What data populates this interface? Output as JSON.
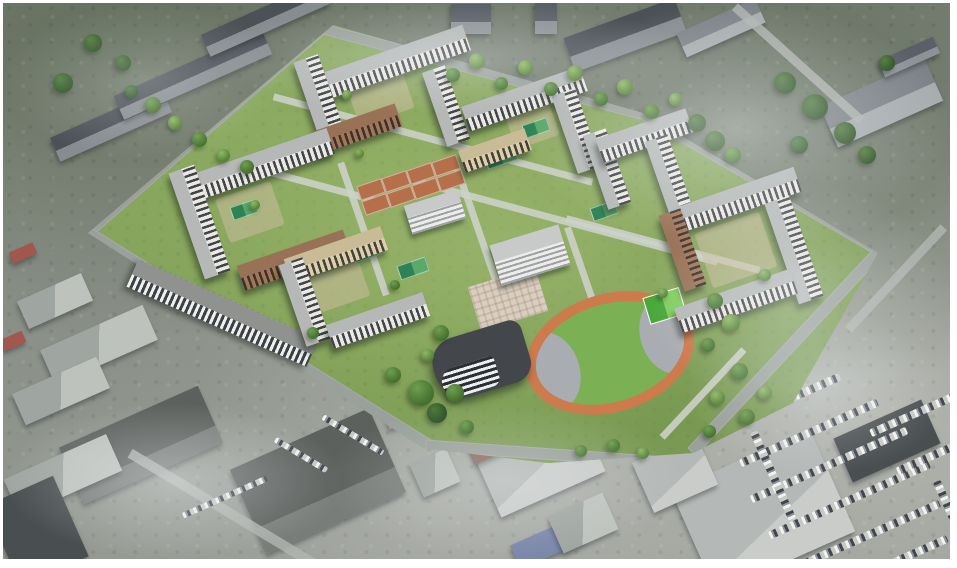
{
  "scene": {
    "description": "Aerial bird's-eye architectural rendering of a new residential masterplan with mid-rise perimeter apartment blocks, a school, a kindergarten, clay sport courts, a stadium with orange running track and a rounded striped parking garage, superimposed on a hazy desaturated aerial photo of surrounding industrial sheds, gray slab buildings, streets and a large car parking lot",
    "palette": {
      "frame": "#ffffff",
      "photo_base": "#8e938c",
      "lawn": "#83a159",
      "road": "#9aa09b",
      "path": "#cdd2cb",
      "facade_light": "#e9e7e1",
      "facade_brown": "#9f6b44",
      "facade_tan": "#dcca9f",
      "window_dark": "#2a2f35",
      "roof_gray": "#b5b8b7",
      "clay_court": "#b5704b",
      "sport_court_dark": "#2e8355",
      "sport_court_light": "#5aa96a",
      "track_orange": "#cd7a4c",
      "infield_green": "#7cb054",
      "end_zone_gray": "#a9adb2",
      "tree_dark": "#2f5226",
      "tree_mid": "#44702f",
      "tree_bright": "#8cba62",
      "haze": "#ebeef0"
    },
    "format_note": "geometry arrays are [cx,cy,w,h,rot,(tone)] in px; trees are [cx,cy,diameter,tone]; haze is [left%,top%,w%,h%,opacity]"
  },
  "surroundings": {
    "buildings": [
      [
        108,
        122,
        122,
        26,
        -24,
        "slab"
      ],
      [
        190,
        72,
        162,
        26,
        -24,
        "slab"
      ],
      [
        263,
        16,
        132,
        24,
        -24,
        "slab"
      ],
      [
        468,
        16,
        40,
        30,
        0,
        "box"
      ],
      [
        543,
        15,
        22,
        32,
        0,
        "box"
      ],
      [
        622,
        32,
        118,
        36,
        -20,
        "slab"
      ],
      [
        718,
        25,
        86,
        26,
        -24,
        "boxlight"
      ],
      [
        878,
        100,
        115,
        45,
        -24,
        "boxlight"
      ],
      [
        906,
        54,
        60,
        18,
        -24,
        "box"
      ],
      [
        52,
        298,
        70,
        30,
        -24,
        "shed"
      ],
      [
        96,
        342,
        112,
        38,
        -24,
        "shed"
      ],
      [
        58,
        388,
        92,
        34,
        -24,
        "shed"
      ],
      [
        138,
        442,
        152,
        62,
        -24,
        "dark"
      ],
      [
        60,
        472,
        112,
        40,
        -24,
        "shed"
      ],
      [
        34,
        528,
        74,
        88,
        -24,
        "darker"
      ],
      [
        20,
        250,
        26,
        12,
        -24,
        "red"
      ],
      [
        10,
        338,
        24,
        12,
        -24,
        "red"
      ],
      [
        315,
        478,
        152,
        92,
        -24,
        "dark"
      ],
      [
        533,
        452,
        114,
        86,
        -24,
        "lightroof"
      ],
      [
        760,
        508,
        152,
        112,
        -24,
        "lightroof"
      ],
      [
        672,
        470,
        70,
        55,
        -24,
        "lightroof"
      ],
      [
        884,
        438,
        96,
        48,
        -24,
        "darker"
      ],
      [
        545,
        540,
        72,
        26,
        -24,
        "blue"
      ],
      [
        492,
        441,
        52,
        22,
        -24,
        "redbrown"
      ],
      [
        404,
        412,
        42,
        16,
        -19,
        "pink"
      ],
      [
        432,
        470,
        40,
        36,
        -24,
        "shed"
      ],
      [
        580,
        520,
        60,
        40,
        -24,
        "shed"
      ]
    ],
    "roads": [
      [
        795,
        60,
        170,
        9,
        42
      ],
      [
        230,
        512,
        240,
        10,
        31
      ],
      [
        893,
        275,
        140,
        9,
        -47
      ]
    ],
    "car_rows": [
      [
        782,
        398,
        120,
        8,
        -24
      ],
      [
        806,
        430,
        150,
        8,
        -24
      ],
      [
        826,
        462,
        170,
        8,
        -24
      ],
      [
        846,
        497,
        175,
        8,
        -24
      ],
      [
        868,
        531,
        150,
        8,
        -24
      ],
      [
        903,
        554,
        90,
        8,
        -24
      ],
      [
        918,
        408,
        110,
        8,
        -24
      ],
      [
        940,
        448,
        100,
        8,
        -24
      ],
      [
        770,
        472,
        8,
        95,
        -24
      ],
      [
        950,
        515,
        8,
        80,
        -24
      ],
      [
        222,
        494,
        92,
        6,
        -24
      ],
      [
        350,
        432,
        70,
        6,
        31
      ],
      [
        298,
        452,
        60,
        6,
        31
      ]
    ]
  },
  "site": {
    "polygon": [
      [
        330,
        22
      ],
      [
        640,
        110
      ],
      [
        875,
        250
      ],
      [
        790,
        400
      ],
      [
        690,
        450
      ],
      [
        545,
        460
      ],
      [
        420,
        445
      ],
      [
        85,
        230
      ]
    ],
    "roads": [
      [
        200,
        128,
        316,
        13,
        -41
      ],
      [
        479,
        68,
        338,
        11,
        15
      ],
      [
        758,
        179,
        278,
        11,
        30
      ],
      [
        254,
        336,
        406,
        14,
        32
      ],
      [
        558,
        452,
        272,
        12,
        4
      ],
      [
        782,
        349,
        274,
        12,
        -47
      ]
    ],
    "paths": [
      [
        430,
        136,
        330,
        7,
        15
      ],
      [
        555,
        216,
        330,
        7,
        15
      ],
      [
        478,
        236,
        7,
        170,
        -19
      ],
      [
        590,
        300,
        7,
        160,
        -19
      ],
      [
        660,
        241,
        200,
        7,
        15
      ],
      [
        360,
        226,
        7,
        140,
        -19
      ],
      [
        305,
        179,
        150,
        7,
        15
      ],
      [
        700,
        390,
        120,
        7,
        -47
      ]
    ],
    "courtyards": [
      [
        733,
        247,
        68,
        58,
        -19
      ],
      [
        378,
        96,
        58,
        38,
        -19
      ],
      [
        247,
        209,
        58,
        46,
        -19
      ],
      [
        337,
        284,
        52,
        36,
        -19
      ],
      [
        530,
        124,
        46,
        32,
        -19
      ]
    ],
    "plazas": [
      [
        505,
        296,
        70,
        46,
        -17
      ]
    ],
    "clay_courts": [
      [
        372,
        200,
        24,
        13,
        -19
      ],
      [
        397,
        192,
        24,
        13,
        -19
      ],
      [
        422,
        184,
        24,
        13,
        -19
      ],
      [
        447,
        176,
        24,
        13,
        -19
      ],
      [
        367,
        185,
        24,
        13,
        -19
      ],
      [
        392,
        177,
        24,
        13,
        -19
      ],
      [
        417,
        169,
        24,
        13,
        -19
      ],
      [
        442,
        161,
        24,
        13,
        -19
      ]
    ],
    "sport_courts": [
      [
        497,
        153,
        30,
        14,
        -19
      ],
      [
        532,
        124,
        24,
        12,
        -19
      ],
      [
        240,
        206,
        24,
        12,
        -19
      ],
      [
        362,
        247,
        26,
        13,
        -19
      ],
      [
        409,
        264,
        28,
        13,
        -19
      ],
      [
        660,
        311,
        26,
        14,
        -19
      ],
      [
        600,
        207,
        24,
        12,
        -19
      ]
    ],
    "residential": [
      [
        388,
        60,
        160,
        27,
        -19,
        "light"
      ],
      [
        317,
        97,
        26,
        88,
        -19,
        "light"
      ],
      [
        354,
        126,
        88,
        24,
        -19,
        "brown"
      ],
      [
        443,
        103,
        24,
        78,
        -19,
        "light"
      ],
      [
        521,
        96,
        125,
        26,
        -19,
        "light"
      ],
      [
        573,
        128,
        25,
        82,
        -19,
        "light"
      ],
      [
        492,
        147,
        70,
        23,
        -19,
        "tan"
      ],
      [
        604,
        166,
        24,
        78,
        -19,
        "light"
      ],
      [
        641,
        132,
        95,
        25,
        -19,
        "light"
      ],
      [
        666,
        173,
        24,
        80,
        -19,
        "light"
      ],
      [
        737,
        196,
        122,
        26,
        -19,
        "light"
      ],
      [
        791,
        247,
        26,
        106,
        -19,
        "light"
      ],
      [
        733,
        298,
        122,
        26,
        -19,
        "light"
      ],
      [
        679,
        247,
        23,
        80,
        -19,
        "brown"
      ],
      [
        256,
        162,
        152,
        27,
        -19,
        "light"
      ],
      [
        196,
        219,
        27,
        112,
        -19,
        "light"
      ],
      [
        291,
        257,
        112,
        26,
        -19,
        "brown"
      ],
      [
        333,
        251,
        102,
        25,
        -19,
        "tan"
      ],
      [
        301,
        299,
        25,
        86,
        -19,
        "light"
      ],
      [
        375,
        317,
        102,
        25,
        -19,
        "light"
      ]
    ],
    "civic": [
      [
        527,
        252,
        72,
        42,
        -17
      ],
      [
        432,
        209,
        56,
        30,
        -17
      ]
    ],
    "stadium": {
      "x": 607,
      "y": 350,
      "w": 172,
      "h": 118,
      "rot": -17,
      "courts": {
        "x": 151,
        "y": 29,
        "w": 36,
        "h": 26
      }
    },
    "garage": [
      478,
      358,
      96,
      62,
      -17
    ],
    "parking_strip": [
      219,
      310,
      197,
      30,
      24
    ]
  },
  "trees": [
    [
      450,
      72,
      14,
      "b"
    ],
    [
      474,
      58,
      16,
      "c"
    ],
    [
      498,
      80,
      13,
      "b"
    ],
    [
      522,
      64,
      15,
      "c"
    ],
    [
      548,
      86,
      14,
      "b"
    ],
    [
      572,
      70,
      16,
      "c"
    ],
    [
      598,
      96,
      14,
      "b"
    ],
    [
      622,
      84,
      16,
      "c"
    ],
    [
      648,
      108,
      15,
      "b"
    ],
    [
      672,
      96,
      13,
      "c"
    ],
    [
      694,
      120,
      18,
      "a"
    ],
    [
      712,
      138,
      20,
      "a"
    ],
    [
      730,
      152,
      16,
      "b"
    ],
    [
      128,
      88,
      13,
      "a"
    ],
    [
      150,
      102,
      16,
      "b"
    ],
    [
      172,
      120,
      14,
      "c"
    ],
    [
      196,
      136,
      15,
      "b"
    ],
    [
      220,
      152,
      13,
      "c"
    ],
    [
      244,
      164,
      14,
      "b"
    ],
    [
      712,
      298,
      16,
      "b"
    ],
    [
      728,
      320,
      18,
      "c"
    ],
    [
      705,
      342,
      14,
      "b"
    ],
    [
      736,
      368,
      17,
      "b"
    ],
    [
      714,
      394,
      15,
      "c"
    ],
    [
      744,
      414,
      16,
      "b"
    ],
    [
      706,
      428,
      13,
      "b"
    ],
    [
      762,
      390,
      14,
      "c"
    ],
    [
      438,
      330,
      16,
      "b"
    ],
    [
      424,
      352,
      13,
      "c"
    ],
    [
      452,
      390,
      18,
      "b"
    ],
    [
      434,
      410,
      20,
      "a"
    ],
    [
      464,
      424,
      14,
      "b"
    ],
    [
      610,
      442,
      13,
      "b"
    ],
    [
      640,
      450,
      12,
      "c"
    ],
    [
      578,
      448,
      12,
      "b"
    ],
    [
      344,
      92,
      10,
      "c"
    ],
    [
      252,
      202,
      10,
      "c"
    ],
    [
      392,
      282,
      10,
      "b"
    ],
    [
      762,
      272,
      12,
      "c"
    ],
    [
      660,
      290,
      10,
      "c"
    ],
    [
      356,
      150,
      9,
      "c"
    ],
    [
      310,
      330,
      12,
      "b"
    ],
    [
      782,
      80,
      22,
      "a"
    ],
    [
      812,
      104,
      26,
      "a"
    ],
    [
      842,
      130,
      22,
      "a"
    ],
    [
      796,
      142,
      18,
      "a"
    ],
    [
      864,
      152,
      18,
      "a"
    ],
    [
      884,
      60,
      16,
      "a"
    ],
    [
      90,
      40,
      18,
      "a"
    ],
    [
      120,
      60,
      16,
      "a"
    ],
    [
      60,
      80,
      20,
      "a"
    ],
    [
      418,
      390,
      26,
      "b"
    ],
    [
      390,
      372,
      16,
      "b"
    ]
  ],
  "haze": [
    [
      55,
      0,
      45,
      45,
      0.5
    ],
    [
      68,
      32,
      32,
      42,
      0.4
    ],
    [
      0,
      72,
      36,
      28,
      0.45
    ],
    [
      0,
      0,
      30,
      28,
      0.3
    ],
    [
      34,
      72,
      38,
      28,
      0.33
    ],
    [
      22,
      0,
      52,
      20,
      0.38
    ],
    [
      72,
      55,
      28,
      30,
      0.35
    ]
  ]
}
